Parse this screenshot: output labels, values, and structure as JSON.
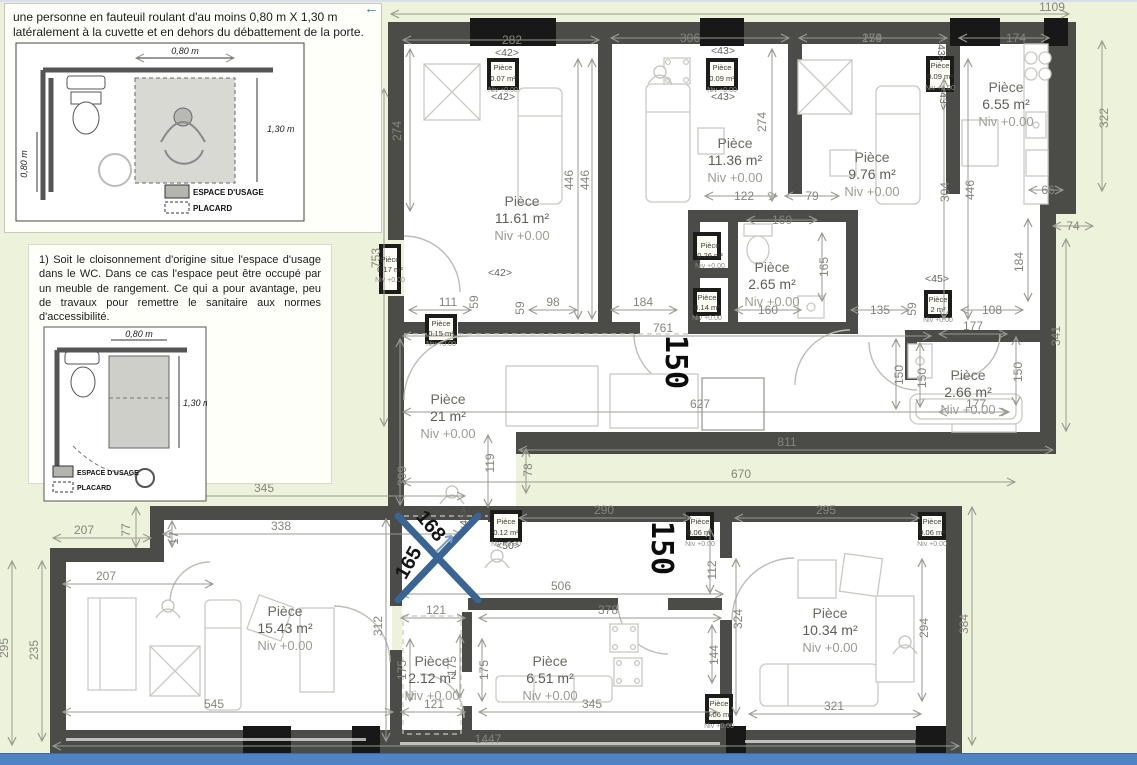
{
  "panel1": {
    "text": "une personne en fauteuil roulant d'au moins 0,80 m X 1,30 m latéralement à la cuvette et en dehors du débattement de la porte.",
    "inset": {
      "dim_top": "0,80 m",
      "dim_right": "1,30 m",
      "dim_left": "0,80 m",
      "legend_espace": "ESPACE D'USAGE",
      "legend_placard": "PLACARD"
    }
  },
  "panel2": {
    "text": "1) Soit le cloisonnement d'origine situe l'espace d'usage dans le WC. Dans ce cas l'espace peut être occupé par un meuble de rangement. Ce qui a pour avantage, peu de travaux pour remettre le sanitaire aux normes d'accessibilité.",
    "inset": {
      "dim_top": "0,80 m",
      "dim_right": "1,30 m",
      "legend_espace": "ESPACE D'USAGE",
      "legend_placard": "PLACARD"
    }
  },
  "plan": {
    "rooms": [
      {
        "name": "Pièce",
        "area": "11.61 m²",
        "niv": "Niv +0.00"
      },
      {
        "name": "Pièce",
        "area": "11.36 m²",
        "niv": "Niv +0.00"
      },
      {
        "name": "Pièce",
        "area": "9.76 m²",
        "niv": "Niv +0.00"
      },
      {
        "name": "Pièce",
        "area": "6.55 m²",
        "niv": "Niv +0.00"
      },
      {
        "name": "Pièce",
        "area": "2.65 m²",
        "niv": "Niv +0.00"
      },
      {
        "name": "Pièce",
        "area": "2.66 m²",
        "niv": "Niv +0.00"
      },
      {
        "name": "Pièce",
        "area": "21 m²",
        "niv": "Niv +0.00"
      },
      {
        "name": "Pièce",
        "area": "15.43 m²",
        "niv": "Niv +0.00"
      },
      {
        "name": "Pièce",
        "area": "2.12 m²",
        "niv": "Niv +0.00"
      },
      {
        "name": "Pièce",
        "area": "6.51 m²",
        "niv": "Niv +0.00"
      },
      {
        "name": "Pièce",
        "area": "10.34 m²",
        "niv": "Niv +0.00"
      },
      {
        "name": "Pièce",
        "area": "0.26 m²",
        "niv": "Niv +0.00"
      }
    ],
    "small": [
      {
        "name": "Pièce",
        "area": "0.07 m²",
        "niv": "Niv +0.00"
      },
      {
        "name": "Pièce",
        "area": "0.09 m²",
        "niv": "Niv +0.00"
      },
      {
        "name": "Pièce",
        "area": "0.09 m²",
        "niv": "Niv +0.00"
      },
      {
        "name": "Pièce",
        "area": "0.15 m²",
        "niv": "Niv +0.00"
      },
      {
        "name": "Pièce",
        "area": "0.17 m²",
        "niv": "Niv +0.00"
      },
      {
        "name": "Pièce",
        "area": "0.14 m²",
        "niv": "Niv +0.00"
      },
      {
        "name": "Pièce",
        "area": "2 m²",
        "niv": "Niv +0.00"
      },
      {
        "name": "Pièce",
        "area": "0.12 m²",
        "niv": "Niv +0.00"
      },
      {
        "name": "Pièce",
        "area": "0.06 m²",
        "niv": "Niv +0.00"
      },
      {
        "name": "Pièce",
        "area": "0.06 m²",
        "niv": "Niv +0.00"
      },
      {
        "name": "Pièce",
        "area": "0.06 m²",
        "niv": "Niv +0.00"
      }
    ],
    "markers": {
      "m42a": "<42>",
      "m42b": "<42>",
      "m42c": "<42>",
      "m43a": "<43>",
      "m43b": "<43>",
      "m43c": "<43>",
      "m43d": "<43>",
      "m45": "<45>",
      "m49": "<49>",
      "m50": "<50>"
    },
    "dims": {
      "top_total": "1109",
      "bottom_total": "1447",
      "s282": "282",
      "s306": "306",
      "s259": "259",
      "s174": "174",
      "v322": "322",
      "v274a": "274",
      "v274b": "274",
      "v446a": "446",
      "v446b": "446",
      "v446c": "446",
      "v304": "304",
      "h66": "66",
      "h74": "74",
      "v184": "184",
      "v341": "341",
      "h122": "122",
      "h79": "79",
      "h160a": "160",
      "h160b": "160",
      "v165": "165",
      "h135": "135",
      "v59a": "59",
      "v59b": "59",
      "v59c": "59",
      "h108": "108",
      "h177a": "177",
      "h177b": "177",
      "v150a": "150",
      "v150b": "150",
      "v150c": "150",
      "h761": "761",
      "h111": "111",
      "h98": "98",
      "h184": "184",
      "h627": "627",
      "v119": "119",
      "v78": "78",
      "v399": "399",
      "v753": "753",
      "h811": "811",
      "h670": "670",
      "h345a": "345",
      "v77": "77",
      "v17": "17",
      "h338": "338",
      "h207a": "207",
      "h207b": "207",
      "v295": "295",
      "v235": "235",
      "v312": "312",
      "h545": "545",
      "h121a": "121",
      "h121b": "121",
      "v175a": "175",
      "v175b": "175",
      "v175c": "175",
      "h378": "378",
      "h345b": "345",
      "v144": "144",
      "v324": "324",
      "h290": "290",
      "h506": "506",
      "h295b": "295",
      "v112": "112",
      "v294": "294",
      "v384": "384",
      "h321": "321"
    },
    "annot": {
      "diag_a": "168",
      "diag_b": "165",
      "big_a": "150",
      "big_b": "150",
      "arrow": "←"
    },
    "colors": {
      "wall": "#4b4b48",
      "accent_blue": "#3a6494",
      "background": "#edf2da",
      "bottom_bar": "#4f83c3"
    }
  }
}
